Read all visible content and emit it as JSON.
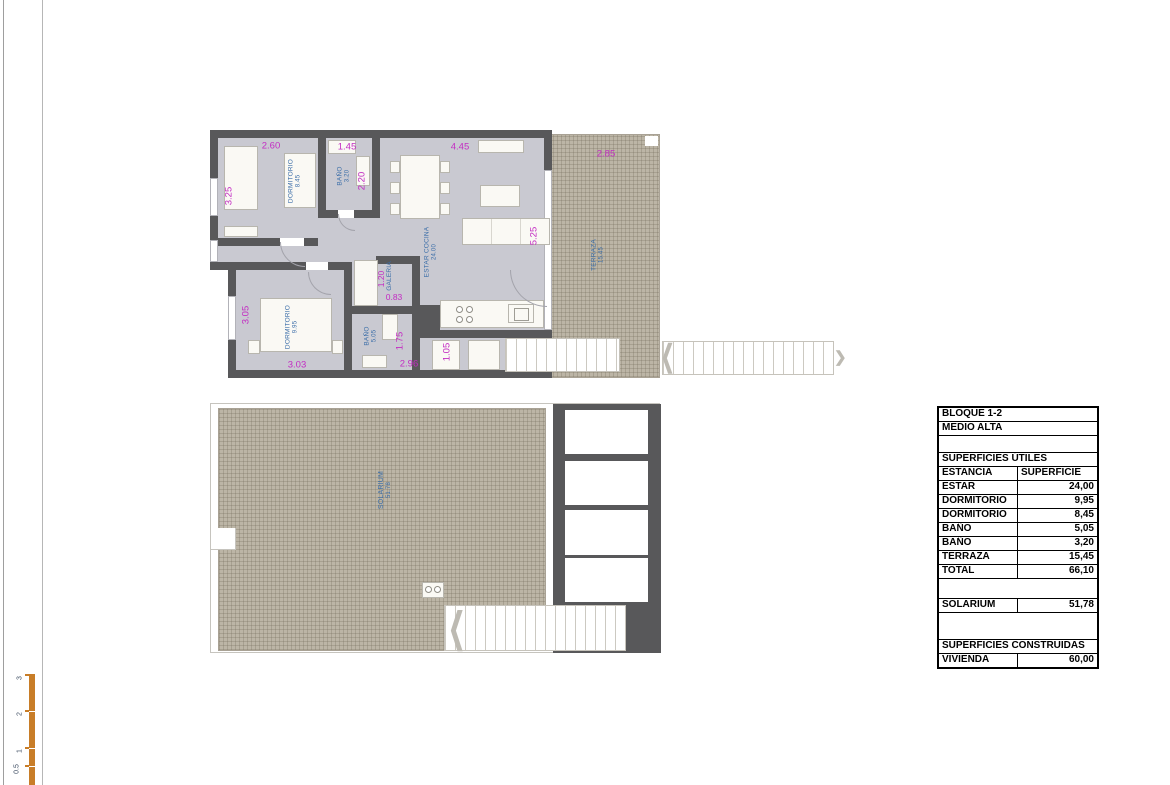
{
  "colors": {
    "wall": "#58585a",
    "floor": "#c9c9d1",
    "terrace_hatch": "#bcb5a6",
    "dimension_text": "#c32cc3",
    "room_text": "#3a6da8",
    "scale_bar": "#c87d28",
    "table_border": "#000000"
  },
  "icons": {
    "stair_arrow_left": "❮",
    "stair_arrow_right": "❯"
  },
  "plan_upper": {
    "dims": [
      "2.60",
      "1.45",
      "4.45",
      "2.85",
      "3.25",
      "2.20",
      "5.25",
      "3.05",
      "1.20",
      "0.83",
      "1.75",
      "3.03",
      "2.96",
      "1.05"
    ],
    "rooms": [
      {
        "name": "DORMITORIO",
        "area": "8.45"
      },
      {
        "name": "BAÑO",
        "area": "3.20"
      },
      {
        "name": "ESTAR COCINA",
        "area": "24.00"
      },
      {
        "name": "TERRAZA",
        "area": "15.45"
      },
      {
        "name": "DORMITORIO",
        "area": "9.95"
      },
      {
        "name": "BAÑO",
        "area": "5.05"
      },
      {
        "name": "GALERIA",
        "area": ""
      }
    ]
  },
  "plan_lower": {
    "rooms": [
      {
        "name": "SOLARIUM",
        "area": "51.78"
      }
    ]
  },
  "table": {
    "rows": [
      {
        "type": "full",
        "label": "BLOQUE 1-2"
      },
      {
        "type": "full",
        "label": "MEDIO ALTA"
      },
      {
        "type": "spacer",
        "label": ""
      },
      {
        "type": "full",
        "label": "SUPERFICIES ÚTILES"
      },
      {
        "type": "header",
        "label": "ESTANCIA",
        "value": "SUPERFICIE"
      },
      {
        "type": "data",
        "label": "ESTAR COCINA",
        "value": "24,00"
      },
      {
        "type": "data",
        "label": "DORMITORIO",
        "value": "9,95"
      },
      {
        "type": "data",
        "label": "DORMITORIO",
        "value": "8,45"
      },
      {
        "type": "data",
        "label": "BAÑO",
        "value": "5,05"
      },
      {
        "type": "data",
        "label": "BAÑO",
        "value": "3,20"
      },
      {
        "type": "data",
        "label": "TERRAZA",
        "value": "15,45"
      },
      {
        "type": "data",
        "label": "TOTAL",
        "value": "66,10"
      },
      {
        "type": "spacer",
        "label": ""
      },
      {
        "type": "data",
        "label": "SOLARIUM",
        "value": "51,78"
      },
      {
        "type": "spacer",
        "label": ""
      },
      {
        "type": "full",
        "label": "SUPERFICIES CONSTRUIDAS"
      },
      {
        "type": "data",
        "label": "VIVIENDA",
        "value": "60,00"
      }
    ]
  },
  "scale": {
    "labels": [
      "3",
      "2",
      "1",
      "0.5"
    ]
  }
}
